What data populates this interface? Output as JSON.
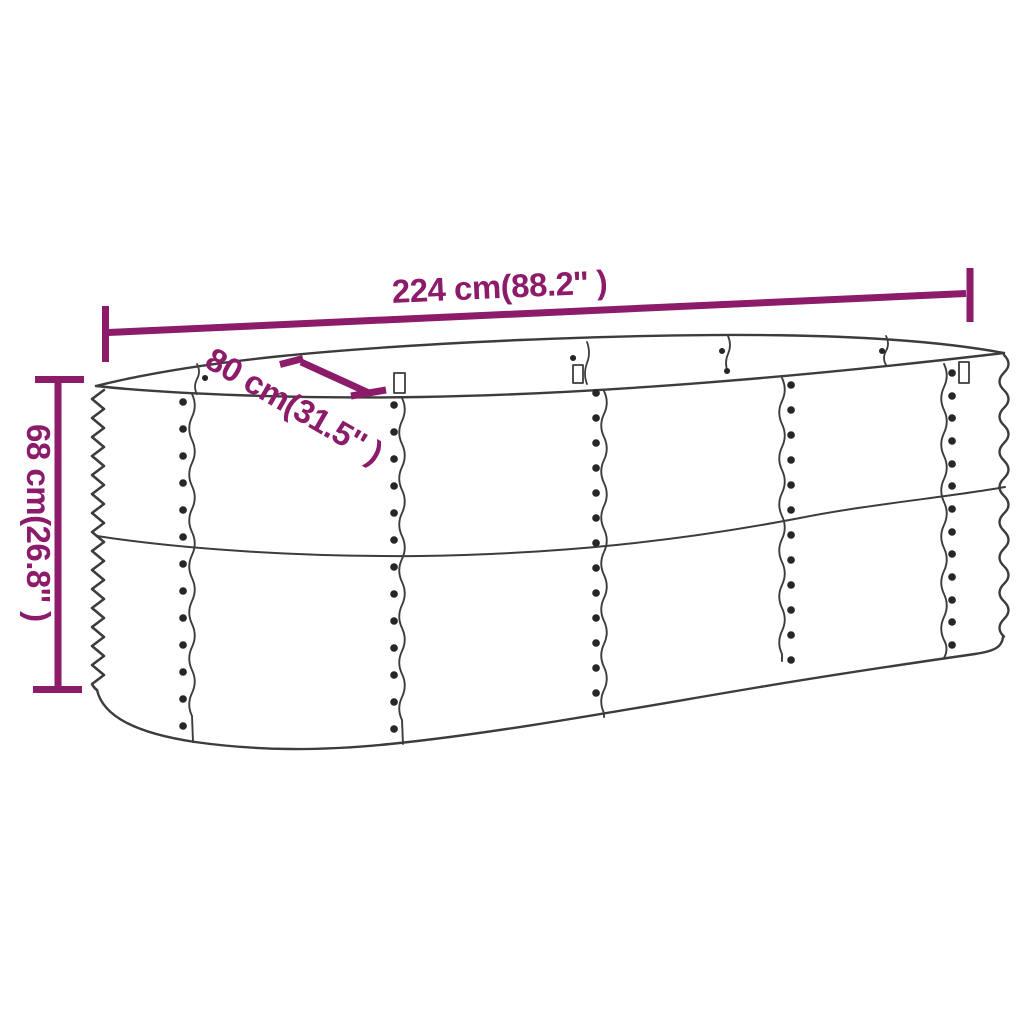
{
  "diagram": {
    "kind": "product-dimension-diagram",
    "dimensions": {
      "length": {
        "text": "224 cm(88.2'' )",
        "cm": 224,
        "inch": 88.2
      },
      "width": {
        "text": "80 cm(31.5'' )",
        "cm": 80,
        "inch": 31.5
      },
      "height": {
        "text": "68 cm(26.8'' )",
        "cm": 68,
        "inch": 26.8
      }
    },
    "colors": {
      "dimension_annotation": "#8C1B6A",
      "line_art": "#3C3C3C",
      "rivet": "#262626",
      "background": "#FFFFFF"
    }
  }
}
